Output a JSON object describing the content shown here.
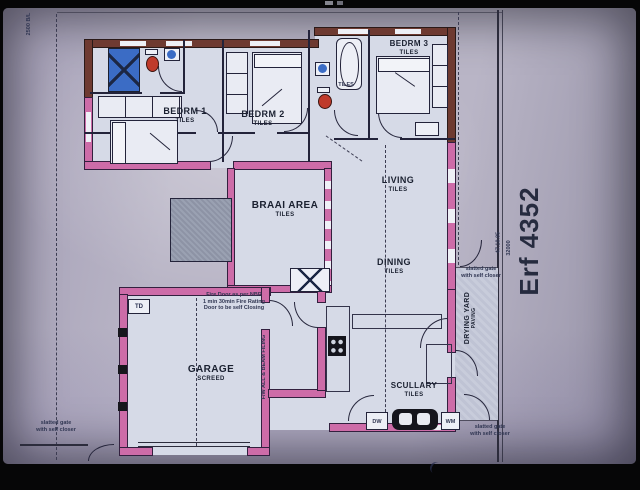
{
  "colors": {
    "wall_pink": "#cd6ca8",
    "wall_face_brick": "#6e3a31",
    "fixture_blue": "#3b6cc5",
    "fixture_red": "#bf3a2b",
    "paper": "#b9b5c6",
    "ink": "#1a2030"
  },
  "site": {
    "erf_label": "Erf 4352",
    "bearing": "47.10.05",
    "boundary_dim": "32000",
    "building_line": "2500 B/L"
  },
  "rooms": {
    "bedrm1": {
      "name": "BEDRM 1",
      "finish": "TILES"
    },
    "bedrm2": {
      "name": "BEDRM 2",
      "finish": "TILES"
    },
    "bedrm3": {
      "name": "BEDRM 3",
      "finish": "TILES"
    },
    "bath": {
      "finish": "TILES"
    },
    "braai": {
      "name": "BRAAI AREA",
      "finish": "TILES"
    },
    "living": {
      "name": "LIVING",
      "finish": "TILES"
    },
    "dining": {
      "name": "DINING",
      "finish": "TILES"
    },
    "garage": {
      "name": "GARAGE",
      "finish": "SCREED"
    },
    "scullery": {
      "name": "SCULLARY",
      "finish": "TILES"
    },
    "drying_yard": {
      "name": "DRYING YARD",
      "finish": "PAVING"
    }
  },
  "fixtures": {
    "trap_door": "TD",
    "dishwasher": "DW",
    "washing_machine": "WM"
  },
  "notes": {
    "fire_door_line1": "Fire Door as per NBR",
    "fire_door_line2": "1 min 30min Fire Rating",
    "fire_door_line3": "Door to be self Closing",
    "gate_line1": "slatted gate",
    "gate_line2": "with self closer",
    "garage_wall_note": "F/W ALL & BEAM FILING"
  }
}
